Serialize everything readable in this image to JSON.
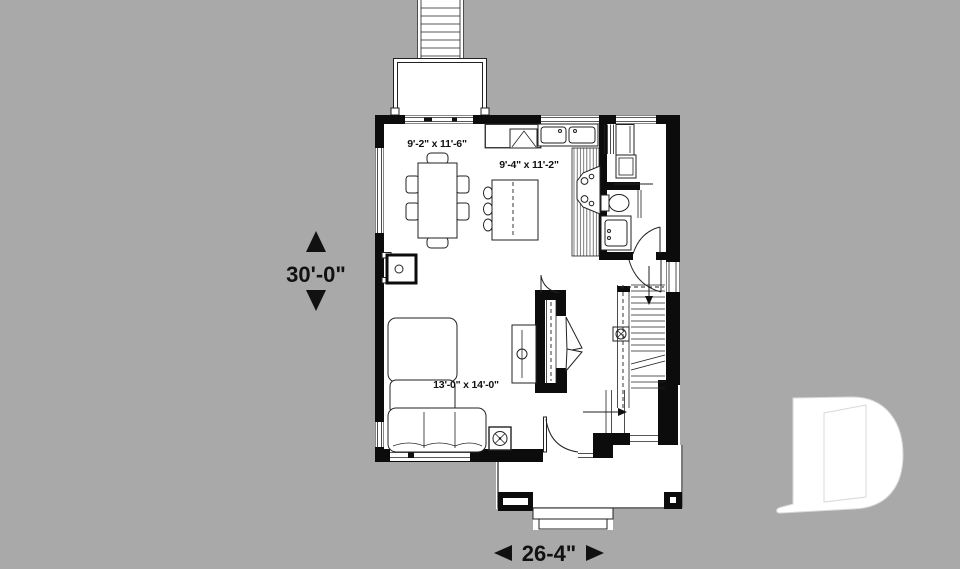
{
  "page": {
    "type": "first-floor-plan-rendering"
  },
  "colors": {
    "background": "#a9a9a9",
    "plan_fill": "#ffffff",
    "wall": "#0c0c0c",
    "line": "#222222",
    "logo_fill": "#ffffff",
    "logo_stroke": "#d9d9d9"
  },
  "annotations": {
    "overall_depth": "30'-0\"",
    "overall_width": "26-4\""
  },
  "rooms": {
    "dining": {
      "size": "9'-2\" x 11'-6\""
    },
    "kitchen": {
      "size": "9'-4\" x 11'-2\""
    },
    "living": {
      "size": "13'-0\" x 14'-0\""
    }
  }
}
